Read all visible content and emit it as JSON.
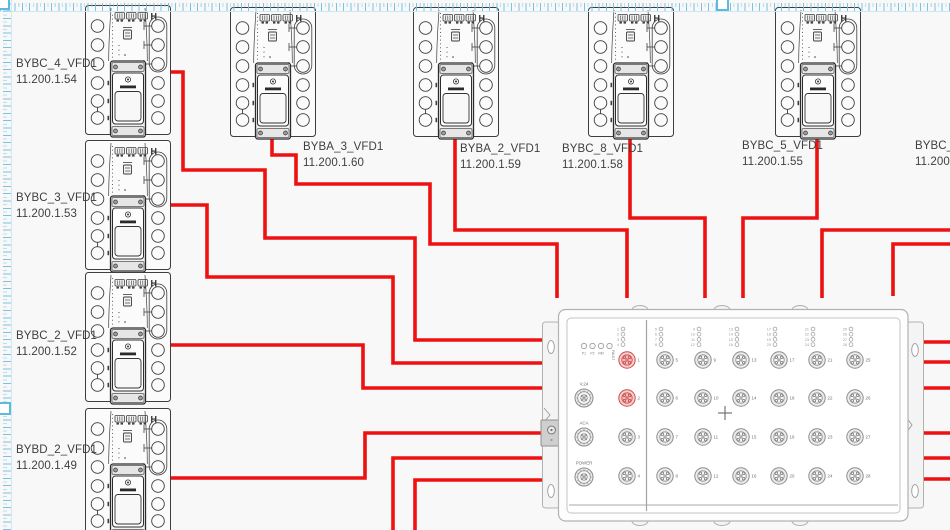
{
  "canvas": {
    "background": "#f8f8f8",
    "selection_color": "#5fb9dd",
    "cable_color": "#ed1111"
  },
  "vfd_marker": "H",
  "devices": [
    {
      "name": "BYBC_4_VFD1",
      "ip": "11.200.1.54",
      "x": 85,
      "y": 5,
      "label_x": 16,
      "label_y": 56
    },
    {
      "name": "BYBC_3_VFD1",
      "ip": "11.200.1.53",
      "x": 85,
      "y": 140,
      "label_x": 16,
      "label_y": 190
    },
    {
      "name": "BYBC_2_VFD1",
      "ip": "11.200.1.52",
      "x": 85,
      "y": 272,
      "label_x": 16,
      "label_y": 328
    },
    {
      "name": "BYBD_2_VFD1",
      "ip": "11.200.1.49",
      "x": 85,
      "y": 408,
      "label_x": 16,
      "label_y": 442
    },
    {
      "name": "BYBA_3_VFD1",
      "ip": "11.200.1.60",
      "x": 230,
      "y": 7,
      "label_x": 303,
      "label_y": 139
    },
    {
      "name": "BYBA_2_VFD1",
      "ip": "11.200.1.59",
      "x": 413,
      "y": 7,
      "label_x": 460,
      "label_y": 141
    },
    {
      "name": "BYBC_8_VFD1",
      "ip": "11.200.1.58",
      "x": 588,
      "y": 7,
      "label_x": 562,
      "label_y": 141
    },
    {
      "name": "BYBC_5_VFD1",
      "ip": "11.200.1.55",
      "x": 775,
      "y": 7,
      "label_x": 742,
      "label_y": 138
    },
    {
      "name": "BYBC_6_",
      "ip": "11.200.1",
      "x": null,
      "y": null,
      "label_x": 915,
      "label_y": 138,
      "offscreen": true
    }
  ],
  "switch": {
    "x": 545,
    "y": 305,
    "status_leds": [
      "P1",
      "P2",
      "RM",
      "FAULT"
    ],
    "side_ports": [
      "V.24",
      "ACA",
      "POWER"
    ],
    "port_numbers": [
      1,
      2,
      3,
      4,
      5,
      6,
      7,
      8,
      9,
      10,
      11,
      12,
      13,
      14,
      15,
      16,
      17,
      18,
      19,
      20,
      21,
      22,
      23,
      24,
      25,
      26,
      27,
      28
    ],
    "highlighted_ports": [
      1,
      2
    ]
  },
  "cables": [
    {
      "from": "BYBC_4_VFD1",
      "to": "switch-left-1",
      "path": "M171,72 H183 V170 H265 V238 H415 V340 H543"
    },
    {
      "from": "BYBC_3_VFD1",
      "to": "switch-left-2",
      "path": "M171,205 H207 V277 H393 V363 H543"
    },
    {
      "from": "BYBC_2_VFD1",
      "to": "switch-left-3",
      "path": "M171,345 H363 V388 H543"
    },
    {
      "from": "BYBD_2_VFD1",
      "to": "switch-left-4",
      "path": "M171,478 H365 V433 H543"
    },
    {
      "from": "offscreen-bottom-1",
      "to": "switch-left-5",
      "path": "M393,532 V458 H543"
    },
    {
      "from": "offscreen-bottom-2",
      "to": "switch-left-6",
      "path": "M415,532 V480 H543"
    },
    {
      "from": "BYBA_3_VFD1",
      "to": "switch-top-1",
      "path": "M272,136 V155 H296 V184 H430 V244 H557 V298"
    },
    {
      "from": "BYBA_2_VFD1",
      "to": "switch-top-2",
      "path": "M455,136 V230 H627 V298"
    },
    {
      "from": "BYBC_8_VFD1",
      "to": "switch-top-3",
      "path": "M630,136 V218 H705 V298"
    },
    {
      "from": "BYBC_5_VFD1",
      "to": "switch-top-4",
      "path": "M817,136 V218 H743 V298"
    },
    {
      "from": "offscreen-right-1",
      "to": "switch-top-5",
      "path": "M952,230 H822 V298"
    },
    {
      "from": "offscreen-right-2",
      "to": "switch-top-6",
      "path": "M952,244 H893 V296"
    },
    {
      "from": "switch-right-1",
      "to": "offscreen-right",
      "path": "M921,342 H952"
    },
    {
      "from": "switch-right-2",
      "to": "offscreen-right",
      "path": "M921,362 H952"
    },
    {
      "from": "switch-right-3",
      "to": "offscreen-right",
      "path": "M921,388 H952"
    },
    {
      "from": "switch-right-4",
      "to": "offscreen-right",
      "path": "M921,433 H952"
    },
    {
      "from": "switch-right-5",
      "to": "offscreen-right",
      "path": "M921,458 H952"
    },
    {
      "from": "switch-right-6",
      "to": "offscreen-right",
      "path": "M921,479 H952"
    }
  ]
}
